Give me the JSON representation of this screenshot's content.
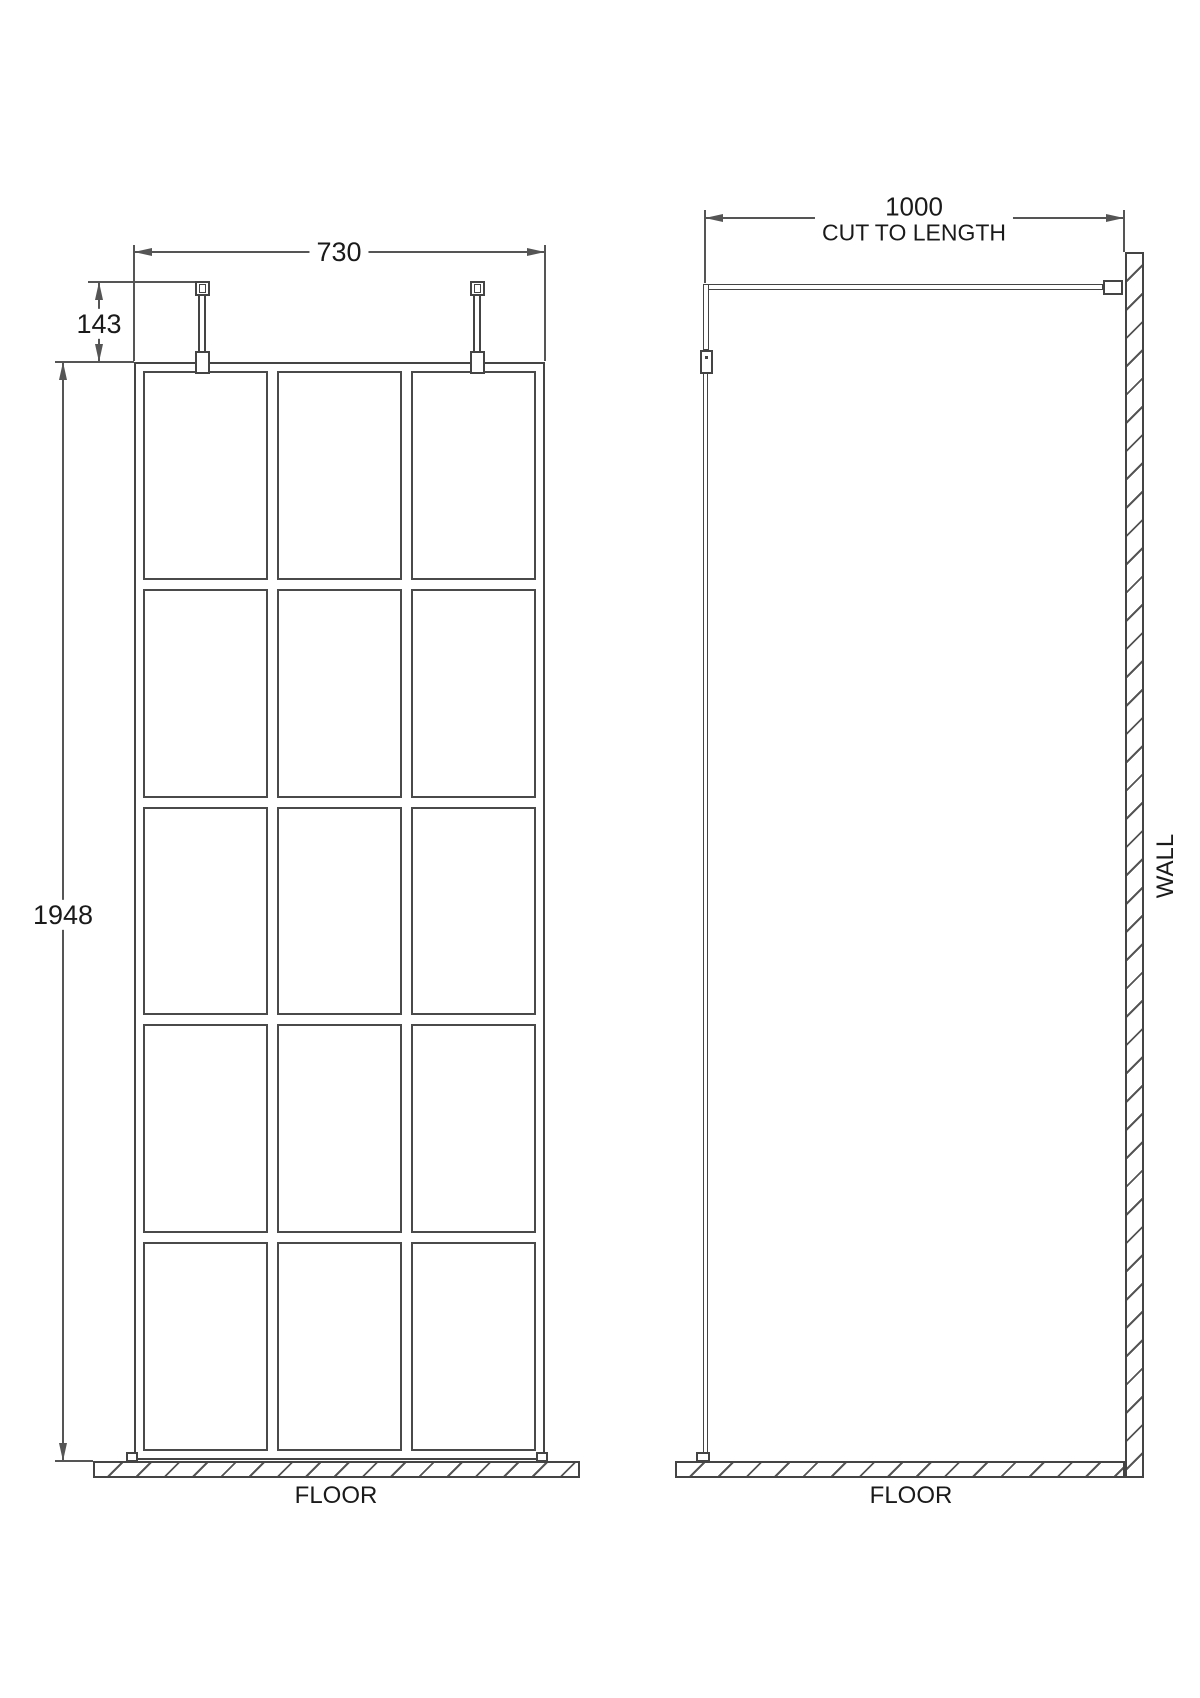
{
  "front_view": {
    "width_dim": "730",
    "fixing_height_dim": "143",
    "height_dim": "1948",
    "floor_label": "FLOOR",
    "grid_rows": 5,
    "grid_cols": 3
  },
  "side_view": {
    "depth_dim": "1000",
    "depth_note": "CUT TO LENGTH",
    "wall_label": "WALL",
    "floor_label": "FLOOR"
  },
  "colors": {
    "geometry_line": "#444444",
    "dimension_line": "#555555",
    "text": "#1a1a1a",
    "background": "#ffffff"
  }
}
